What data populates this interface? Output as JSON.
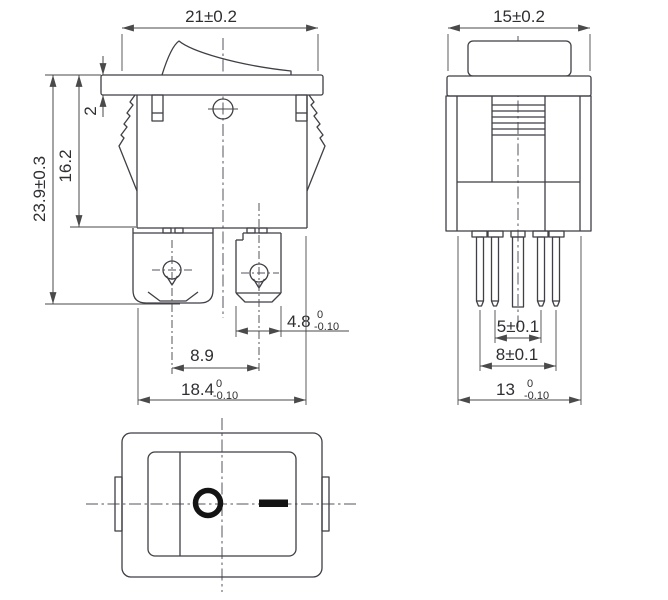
{
  "drawing": {
    "type": "rocker-switch-dimension-drawing",
    "line_color": "#3f3f45",
    "symbol_color": "#141414",
    "background": "#ffffff"
  },
  "front_view": {
    "dim_panel_width": "21±0.2",
    "dim_bezel_thickness": "2",
    "dim_body_height": "16.2",
    "dim_total_height": "23.9±0.3",
    "dim_terminal_width": {
      "value": "4.8",
      "tol_upper": "0",
      "tol_lower": "-0.10"
    },
    "dim_terminal_pitch": "8.9",
    "dim_body_width": {
      "value": "18.4",
      "tol_upper": "0",
      "tol_lower": "-0.10"
    }
  },
  "side_view": {
    "dim_panel_width": "15±0.2",
    "dim_pin_pitch_inner": "5±0.1",
    "dim_pin_pitch_outer": "8±0.1",
    "dim_body_depth": {
      "value": "13",
      "tol_upper": "0",
      "tol_lower": "-0.10"
    }
  },
  "top_view": {
    "marking_off": "O",
    "marking_on": "—"
  }
}
